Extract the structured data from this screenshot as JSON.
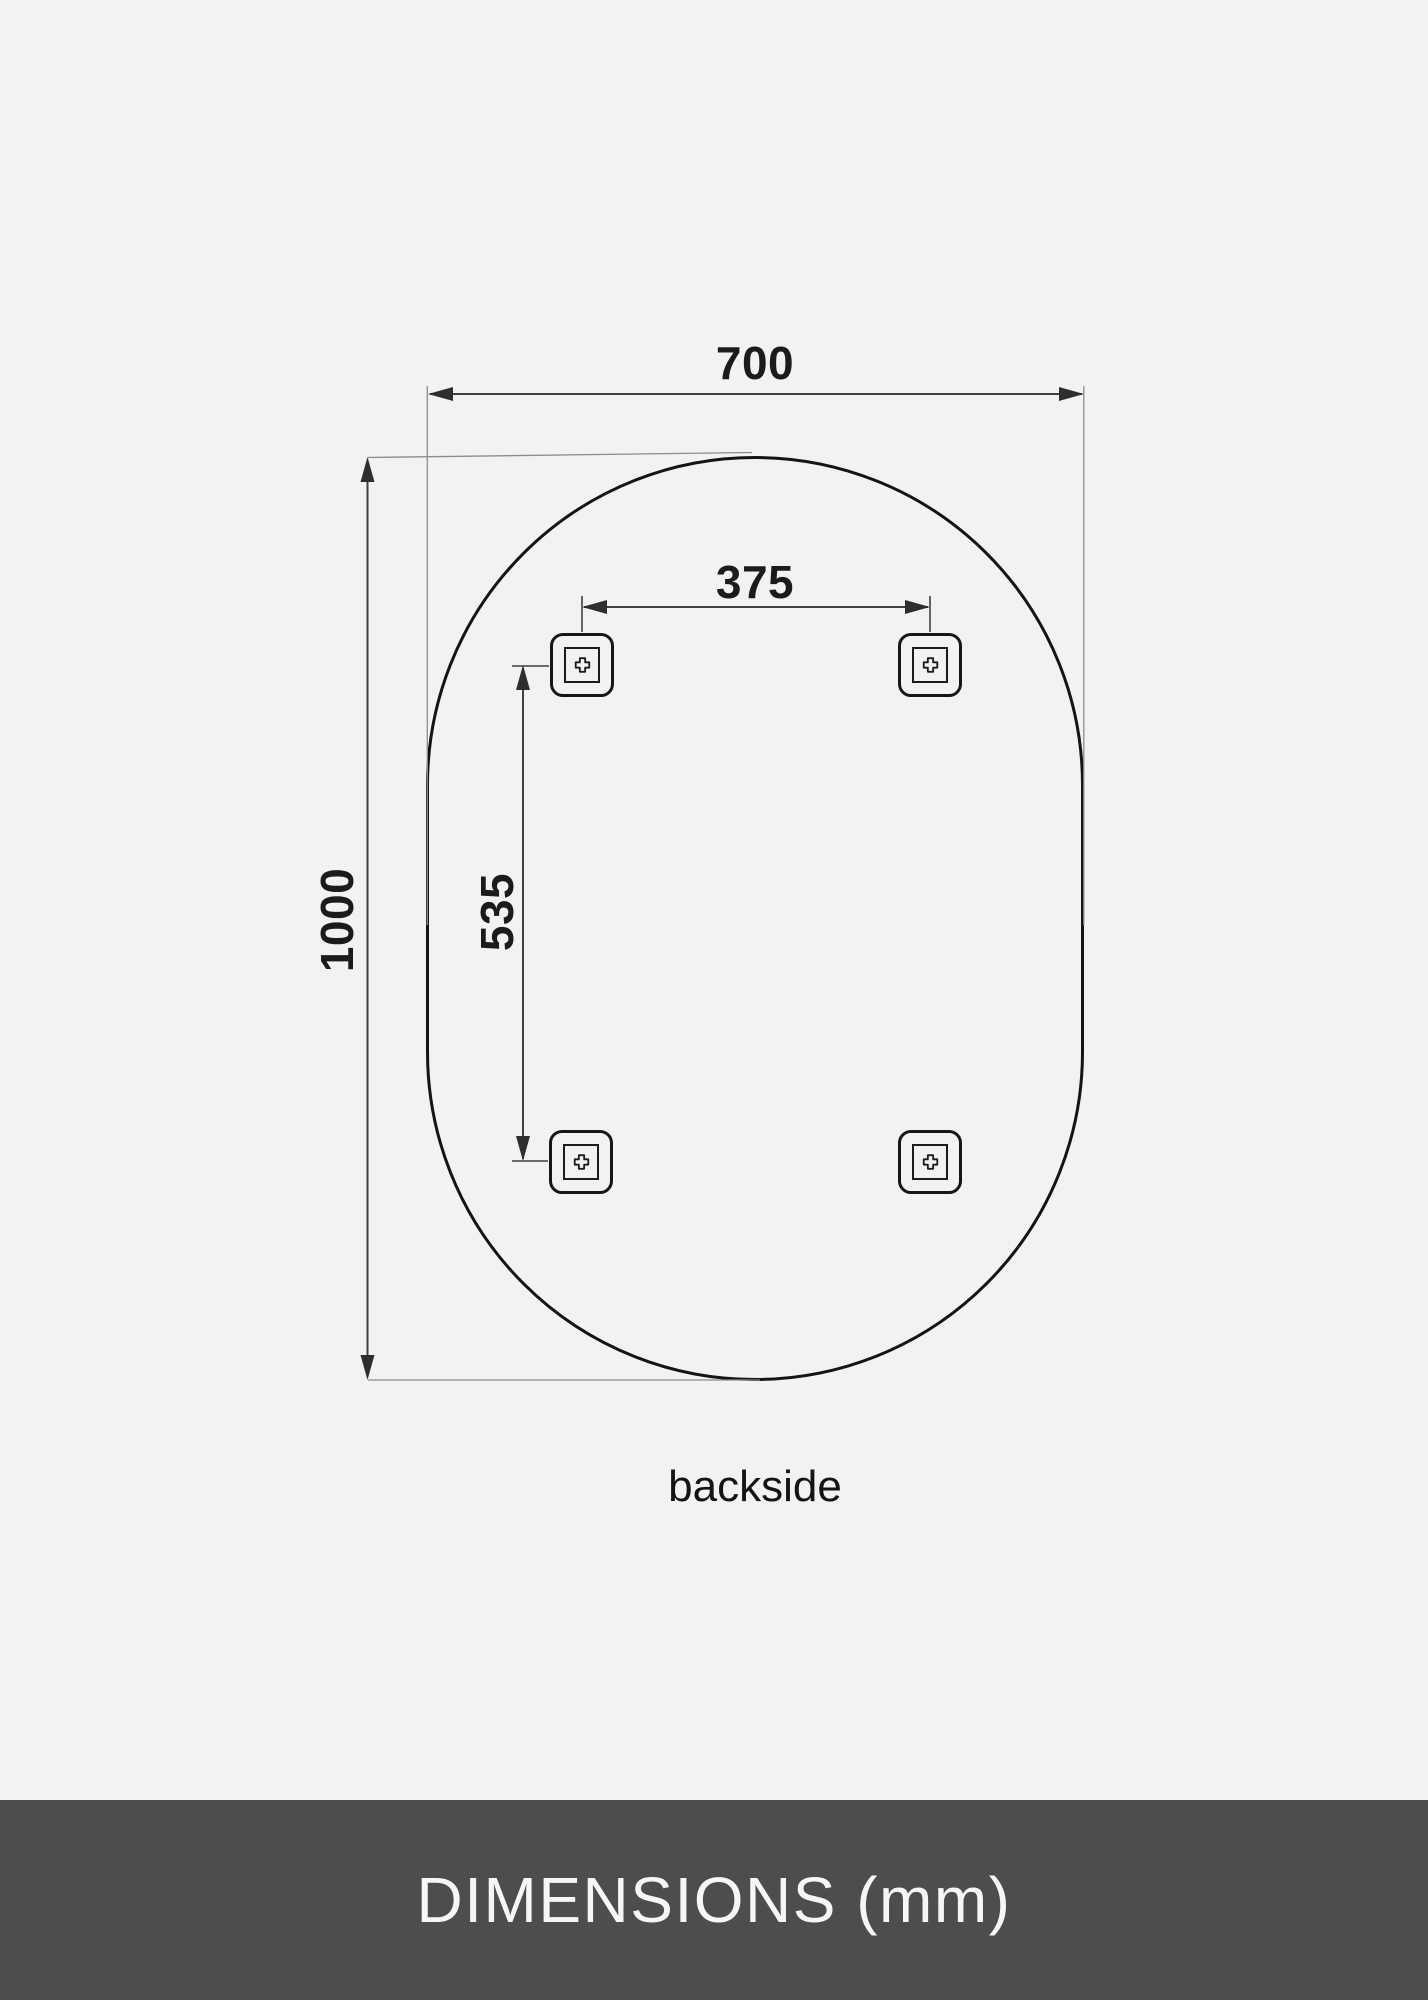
{
  "footer": {
    "label": "DIMENSIONS (mm)"
  },
  "drawing": {
    "view_label": "backside",
    "bracket_count": 4,
    "bracket_icon": "screw-cross",
    "dimensions": [
      {
        "id": "overall-width",
        "value": "700",
        "unit": "mm",
        "orientation": "horizontal"
      },
      {
        "id": "overall-height",
        "value": "1000",
        "unit": "mm",
        "orientation": "vertical"
      },
      {
        "id": "bracket-spacing-horizontal",
        "value": "375",
        "unit": "mm",
        "orientation": "horizontal"
      },
      {
        "id": "bracket-spacing-vertical",
        "value": "535",
        "unit": "mm",
        "orientation": "vertical"
      }
    ]
  },
  "colors": {
    "background": "#f2f2f2",
    "outline": "#141414",
    "dimension_line": "#3f3f3f",
    "extension_line": "#8c8c8c",
    "footer_background": "#4d4d4d",
    "footer_text": "#f6f6f6"
  }
}
